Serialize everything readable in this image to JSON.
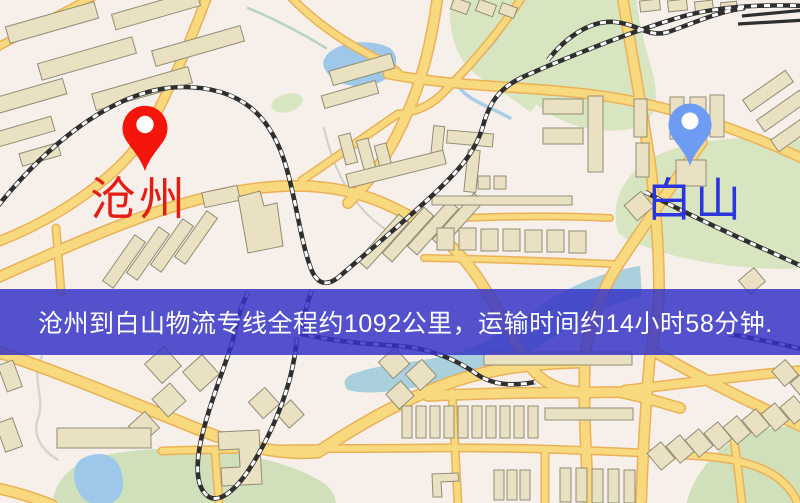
{
  "banner": {
    "text": "沧州到白山物流专线全程约1092公里，运输时间约14小时58分钟."
  },
  "markers": {
    "origin": {
      "label": "沧州"
    },
    "destination": {
      "label": "白山"
    }
  },
  "colors": {
    "bg": "#f7f0ea",
    "road": "#f9d97d",
    "road_casing": "#eab158",
    "railway": "#2f2f2f",
    "building": "#eae1c2",
    "green": "#d7e5c1",
    "green_dark": "#cfe0ba",
    "water": "#9dc8e9",
    "water_band": "#a9d0dc",
    "origin": "#e31d14",
    "destination": "#2b35dd",
    "origin_pin": "#f4150b",
    "destination_pin": "#6f9cf3",
    "banner_bg": "rgba(52,50,198,0.84)",
    "banner_text": "#ffffff"
  }
}
